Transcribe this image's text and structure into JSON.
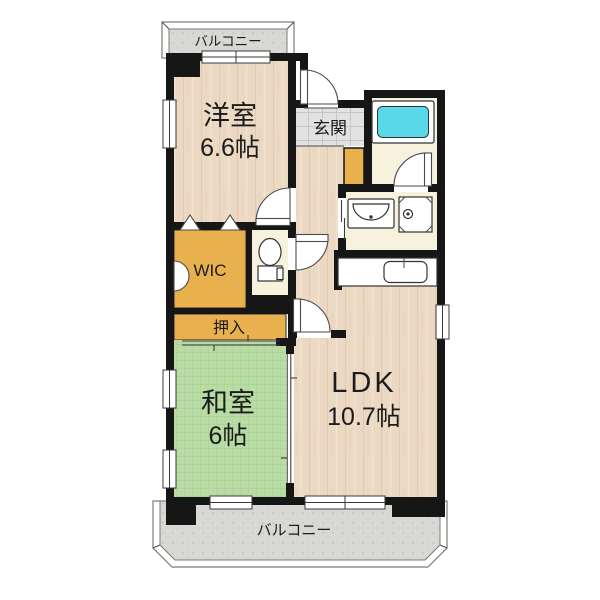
{
  "plan_title": "2LDK apartment floor plan",
  "rooms": {
    "western": {
      "label": "洋室",
      "size": "6.6帖"
    },
    "japanese": {
      "label": "和室",
      "size": "6帖"
    },
    "ldk": {
      "label": "LDK",
      "size": "10.7帖"
    },
    "wic": {
      "label": "WIC"
    },
    "oshiire": {
      "label": "押入"
    },
    "genkan": {
      "label": "玄関"
    },
    "balcony_top": {
      "label": "バルコニー"
    },
    "balcony_bottom": {
      "label": "バルコニー"
    }
  },
  "colors": {
    "wall": "#161616",
    "wood": "#ecd9c3",
    "wood_grain": "#d9bda0",
    "wood_grain_light": "#f4e6d4",
    "tatami": "#b9dca5",
    "tatami_line": "#9cc487",
    "tile": "#e2e2e2",
    "tile_line": "#c6c6c6",
    "storage": "#e9b14d",
    "wet_area": "#f7f2dd",
    "bathtub": "#58d8e9",
    "balcony_floor": "#d8d8d4",
    "balcony_dot": "#c6c6c2"
  },
  "fixtures": {
    "bathtub": "bathtub",
    "toilet": "toilet",
    "wash_basin": "wash-basin",
    "washing_machine_pan": "washing-machine-pan",
    "kitchen_sink": "kitchen-sink-counter"
  }
}
